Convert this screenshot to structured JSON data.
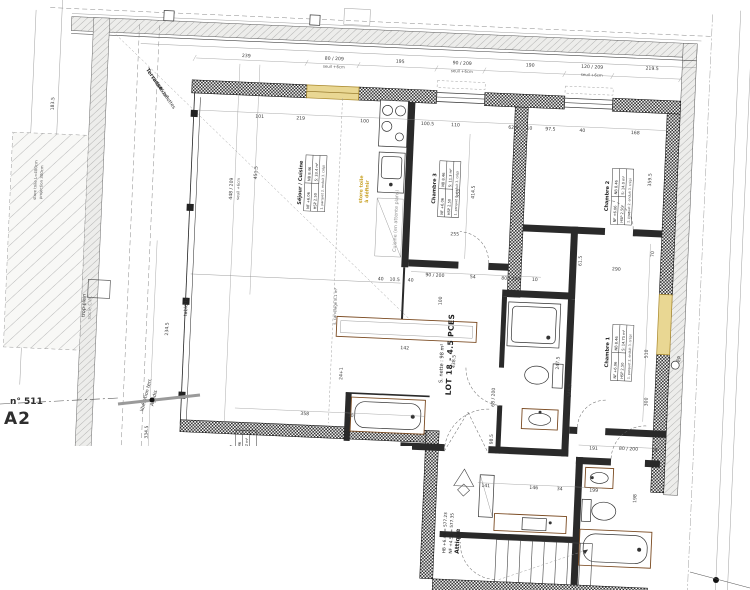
{
  "sheet": {
    "number": "n° 511",
    "code": "A2"
  },
  "lot": {
    "title": "LOT 18 - 4.5 PCES",
    "net_area": "S. nette : 98 m²"
  },
  "attique": {
    "label": "Attique",
    "line1": "NF +4.58 = 577.35",
    "line2": "HB +6.45 = 577.23"
  },
  "rooms": [
    {
      "name": "Séjour / Cuisine",
      "nf": "NF +6.06",
      "nb": "NB 8.46",
      "hsp": "HSP 2.50",
      "s": "S: 33.4 m²",
      "notes": "1. parquet  2. enduit  3. crépi"
    },
    {
      "name": "Chambre 3",
      "nf": "NF +6.06",
      "nb": "NB 8.46",
      "hsp": "HSP 2.50",
      "s": "S: 11.3 m²",
      "notes": "1. parquet  2. enduit  3. crépi"
    },
    {
      "name": "Chambre 2",
      "nf": "NF +6.06",
      "nb": "NB 8.46",
      "hsp": "HSP 2.50",
      "s": "S: 14.0 m²",
      "notes": "1. parquet  2. enduit  3. crépi"
    },
    {
      "name": "Chambre 1",
      "nf": "NF +6.06",
      "nb": "NB 8.46",
      "hsp": "HSP 2.50",
      "s": "S: 14.75 m²",
      "notes": "1. parquet  2. enduit  3. crépi"
    },
    {
      "name": "Chambre",
      "nf": "NF +6.06",
      "nb": "NB 8.46",
      "hsp": "HSP 2.50",
      "s": "S: 14.2 m²",
      "notes": "1. parquet  2. enduit"
    }
  ],
  "colors": {
    "highlight": "#e9d793",
    "wall": "#1c1c1c",
    "dim_text": "#3a3a3a",
    "sanitary": "#7a4a21",
    "yellow_text": "#c9a227"
  },
  "dimensions": [
    {
      "t": "239",
      "x": 236,
      "y": 63
    },
    {
      "t": "80 / 209",
      "x": 324,
      "y": 62
    },
    {
      "t": "seuil +6cm",
      "x": 324,
      "y": 70,
      "cls": "c1"
    },
    {
      "t": "195",
      "x": 390,
      "y": 62
    },
    {
      "t": "90 / 209",
      "x": 452,
      "y": 61
    },
    {
      "t": "seuil +6cm",
      "x": 452,
      "y": 69,
      "cls": "c1"
    },
    {
      "t": "190",
      "x": 520,
      "y": 60
    },
    {
      "t": "120 / 209",
      "x": 582,
      "y": 59
    },
    {
      "t": "seuil +6cm",
      "x": 582,
      "y": 67,
      "cls": "c1"
    },
    {
      "t": "219.5",
      "x": 642,
      "y": 58
    },
    {
      "t": "101",
      "x": 252,
      "y": 123
    },
    {
      "t": "219",
      "x": 293,
      "y": 123
    },
    {
      "t": "100",
      "x": 357,
      "y": 123
    },
    {
      "t": "100.5",
      "x": 420,
      "y": 123
    },
    {
      "t": "110",
      "x": 448,
      "y": 123
    },
    {
      "t": "62.5",
      "x": 506,
      "y": 123
    },
    {
      "t": "10",
      "x": 522,
      "y": 123
    },
    {
      "t": "97.5",
      "x": 543,
      "y": 123
    },
    {
      "t": "40",
      "x": 575,
      "y": 123
    },
    {
      "t": "168",
      "x": 628,
      "y": 123
    },
    {
      "t": "448 / 209",
      "x": 228,
      "y": 195,
      "r": -90
    },
    {
      "t": "seuil +6cm",
      "x": 235,
      "y": 195,
      "r": -90,
      "cls": "c1"
    },
    {
      "t": "451.5",
      "x": 252,
      "y": 178,
      "r": -90
    },
    {
      "t": "234.5",
      "x": 170,
      "y": 338,
      "r": -90
    },
    {
      "t": "334.5",
      "x": 154,
      "y": 442,
      "r": -90
    },
    {
      "t": "183.5",
      "x": 46,
      "y": 118,
      "r": -90
    },
    {
      "t": "store toile L=400cm",
      "x": 32,
      "y": 195,
      "r": -90,
      "cls": "c1"
    },
    {
      "t": "projection 300cm",
      "x": 38,
      "y": 197,
      "r": -90,
      "cls": "c1"
    },
    {
      "t": "414.5",
      "x": 470,
      "y": 188,
      "r": -90
    },
    {
      "t": "353",
      "x": 455,
      "y": 190,
      "r": -90
    },
    {
      "t": "255",
      "x": 452,
      "y": 232
    },
    {
      "t": "40",
      "x": 380,
      "y": 280
    },
    {
      "t": "10.5",
      "x": 394,
      "y": 280
    },
    {
      "t": "40",
      "x": 410,
      "y": 280
    },
    {
      "t": "142",
      "x": 407,
      "y": 348
    },
    {
      "t": "24+1",
      "x": 346,
      "y": 375,
      "r": -90
    },
    {
      "t": "s. carrelage 8.1 m²",
      "x": 337,
      "y": 308,
      "r": -90,
      "cls": "c1"
    },
    {
      "t": "438.5",
      "x": 458,
      "y": 358,
      "r": -90
    },
    {
      "t": "100",
      "x": 442,
      "y": 298,
      "r": -90
    },
    {
      "t": "90 / 200",
      "x": 434,
      "y": 274
    },
    {
      "t": "54",
      "x": 472,
      "y": 274
    },
    {
      "t": "80 / 200",
      "x": 510,
      "y": 274
    },
    {
      "t": "10",
      "x": 534,
      "y": 274
    },
    {
      "t": "68 / 200",
      "x": 499,
      "y": 392,
      "r": -90
    },
    {
      "t": "98.5",
      "x": 499,
      "y": 434,
      "r": -90
    },
    {
      "t": "247.5",
      "x": 562,
      "y": 355,
      "r": -90
    },
    {
      "t": "61.5",
      "x": 580,
      "y": 252,
      "r": -90
    },
    {
      "t": "70",
      "x": 652,
      "y": 242,
      "r": -90
    },
    {
      "t": "290",
      "x": 615,
      "y": 260
    },
    {
      "t": "359.5",
      "x": 646,
      "y": 168,
      "r": -90
    },
    {
      "t": "510",
      "x": 650,
      "y": 342,
      "r": -90
    },
    {
      "t": "300",
      "x": 652,
      "y": 390,
      "r": -90
    },
    {
      "t": "348.5",
      "x": 575,
      "y": 382,
      "r": -90
    },
    {
      "t": "191",
      "x": 600,
      "y": 440
    },
    {
      "t": "80 / 200",
      "x": 635,
      "y": 439
    },
    {
      "t": "19",
      "x": 661,
      "y": 439
    },
    {
      "t": "198",
      "x": 645,
      "y": 487,
      "r": -90
    },
    {
      "t": "141",
      "x": 494,
      "y": 482
    },
    {
      "t": "146",
      "x": 542,
      "y": 482
    },
    {
      "t": "34",
      "x": 568,
      "y": 482
    },
    {
      "t": "199",
      "x": 602,
      "y": 482
    },
    {
      "t": "358",
      "x": 310,
      "y": 418
    },
    {
      "t": "10",
      "x": 356,
      "y": 418
    }
  ],
  "annotations": [
    {
      "t": "Terrasse",
      "x": 144,
      "y": 90,
      "r": 52,
      "b": 1
    },
    {
      "t": "surf: 46 m²",
      "x": 150,
      "y": 98,
      "r": 52
    },
    {
      "t": "sol: dallettes",
      "x": 156,
      "y": 106,
      "r": 52
    },
    {
      "t": "libération terr.",
      "x": 152,
      "y": 405,
      "r": -78
    },
    {
      "t": "Agadis",
      "x": 160,
      "y": 408,
      "r": -78
    },
    {
      "t": "trop-plein",
      "x": 86,
      "y": 318,
      "r": -90
    },
    {
      "t": "socle CVC",
      "x": 92,
      "y": 320,
      "r": -90,
      "cls": "gray"
    },
    {
      "t": "tablette",
      "x": 188,
      "y": 315,
      "r": -90
    },
    {
      "t": "store toile",
      "x": 358,
      "y": 190,
      "r": -90,
      "cls": "yellow"
    },
    {
      "t": "à définir",
      "x": 364,
      "y": 192,
      "r": -90,
      "cls": "yellow"
    },
    {
      "t": "Cuisine (en attente plans)",
      "x": 394,
      "y": 220,
      "r": -90,
      "cls": "gray"
    },
    {
      "t": "EP",
      "x": 683,
      "y": 346,
      "r": -78
    }
  ]
}
